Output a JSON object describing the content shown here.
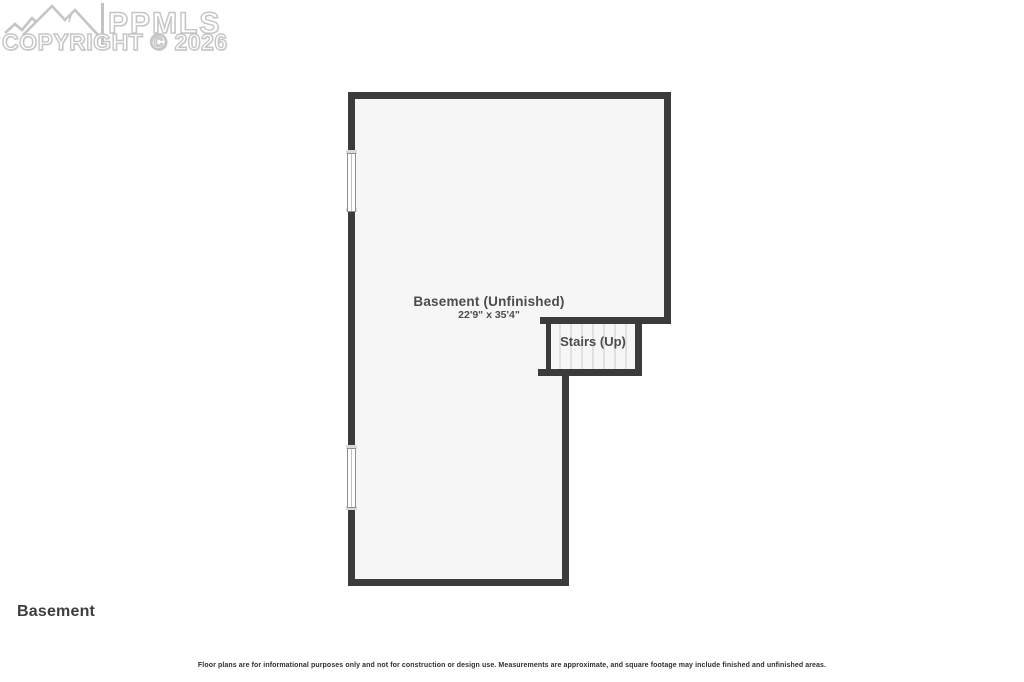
{
  "watermark": {
    "brand": "PPMLS",
    "copyright_line": "COPYRIGHT © 2026",
    "logo": "mountain-range-icon",
    "color": "#c5c5c5"
  },
  "plan": {
    "room": {
      "label": "Basement (Unfinished)",
      "dimensions": "22'9\" x 35'4\""
    },
    "stairs": {
      "label": "Stairs (Up)",
      "tread_count": 8
    },
    "window_count": 2,
    "colors": {
      "wall": "#3b3b3b",
      "floor_fill": "#f6f6f6",
      "tread_line": "#d9d9d9",
      "label_text": "#4c4c4c"
    }
  },
  "footer": {
    "floor_name": "Basement",
    "disclaimer": "Floor plans are for informational purposes only and not for construction or design use. Measurements are approximate, and square footage may include finished and unfinished areas."
  }
}
